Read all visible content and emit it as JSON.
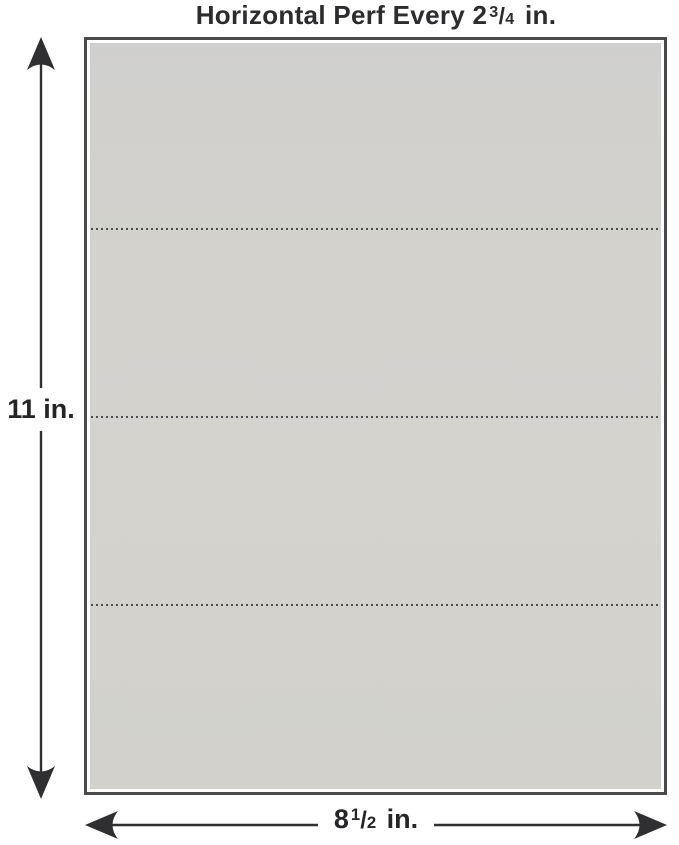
{
  "title": {
    "prefix": "Horizontal Perf Every 2",
    "fraction_numerator": "3",
    "fraction_separator": "/",
    "fraction_denominator": "4",
    "suffix": "in."
  },
  "sheet": {
    "fill": "#d3d2cd",
    "border_color": "#4a4a4c",
    "perforation_style": "dotted",
    "perforation_positions": [
      "25%",
      "50%",
      "75%"
    ],
    "panel_count": 4
  },
  "dimensions": {
    "height_label": "11 in.",
    "width_label": {
      "prefix": "8",
      "fraction_numerator": "1",
      "fraction_separator": "/",
      "fraction_denominator": "2",
      "suffix": "in."
    }
  },
  "colors": {
    "background": "#ffffff",
    "arrow": "#2f2f31",
    "text": "#2c2c2e",
    "perf_dot": "#4c4c4e"
  }
}
